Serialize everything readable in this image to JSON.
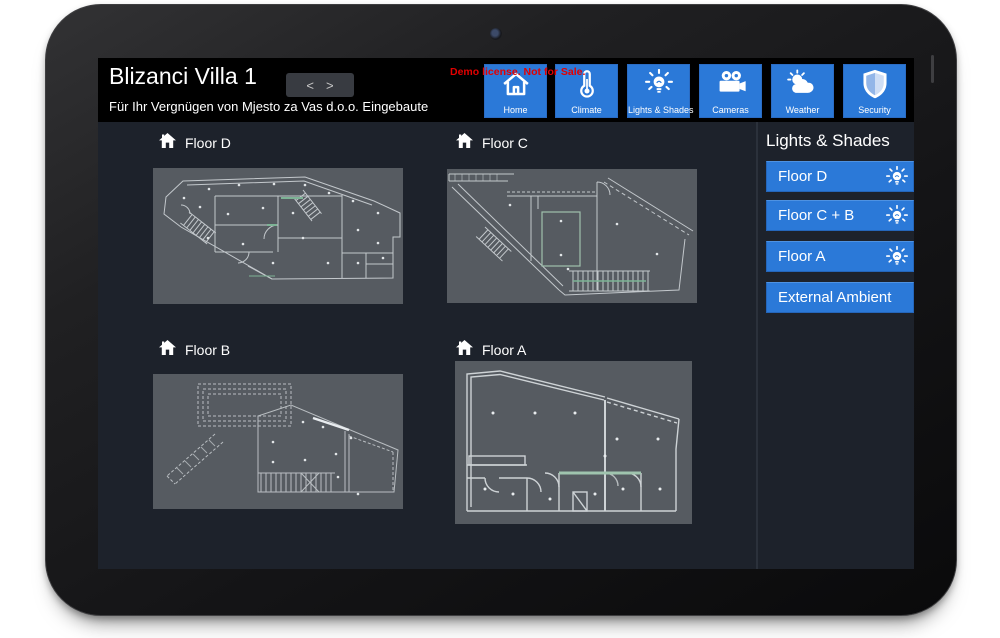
{
  "header": {
    "title": "Blizanci Villa 1",
    "subtitle": "Für Ihr Vergnügen von Mjesto za Vas d.o.o. Eingebaute",
    "pager": {
      "prev": "<",
      "next": ">"
    },
    "watermark": "Demo license. Not for Sale.",
    "nav": [
      {
        "label": "Home",
        "icon": "home-icon"
      },
      {
        "label": "Climate",
        "icon": "thermometer-icon"
      },
      {
        "label": "Lights & Shades",
        "icon": "bulb-icon"
      },
      {
        "label": "Cameras",
        "icon": "video-camera-icon"
      },
      {
        "label": "Weather",
        "icon": "sun-cloud-icon"
      },
      {
        "label": "Security",
        "icon": "shield-icon"
      }
    ]
  },
  "floors": [
    {
      "label": "Floor D",
      "icon": "house-icon"
    },
    {
      "label": "Floor C",
      "icon": "house-icon"
    },
    {
      "label": "Floor B",
      "icon": "house-icon"
    },
    {
      "label": "Floor A",
      "icon": "house-icon"
    }
  ],
  "sidebar": {
    "title": "Lights & Shades",
    "buttons": [
      {
        "label": "Floor D",
        "icon": "bulb-icon"
      },
      {
        "label": "Floor C + B",
        "icon": "bulb-icon"
      },
      {
        "label": "Floor A",
        "icon": "bulb-icon"
      },
      {
        "label": "External Ambient",
        "icon": null
      }
    ]
  },
  "colors": {
    "accent_blue": "#2b79d8",
    "watermark_red": "#e30000",
    "header_bg": "#000000",
    "content_bg": "#1d222b",
    "plan_bg": "#565b61",
    "plan_line": "#c3c8cc",
    "plan_accent_green": "#7db395"
  }
}
